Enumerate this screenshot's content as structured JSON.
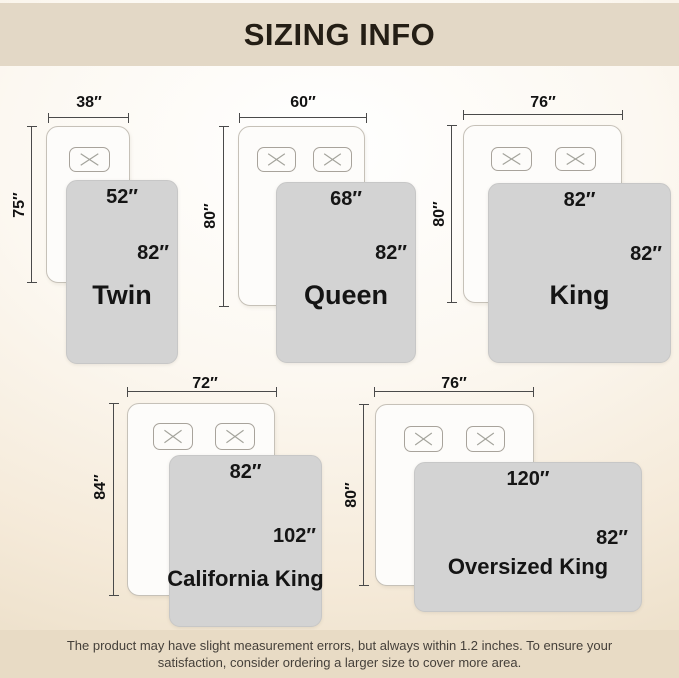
{
  "title": "SIZING INFO",
  "sizes": [
    {
      "name": "Twin",
      "bed_width": "38″",
      "bed_length": "75″",
      "blanket_width": "52″",
      "blanket_length": "82″",
      "pillow_count": 1
    },
    {
      "name": "Queen",
      "bed_width": "60″",
      "bed_length": "80″",
      "blanket_width": "68″",
      "blanket_length": "82″",
      "pillow_count": 2
    },
    {
      "name": "King",
      "bed_width": "76″",
      "bed_length": "80″",
      "blanket_width": "82″",
      "blanket_length": "82″",
      "pillow_count": 2
    },
    {
      "name": "California King",
      "bed_width": "72″",
      "bed_length": "84″",
      "blanket_width": "82″",
      "blanket_length": "102″",
      "pillow_count": 2
    },
    {
      "name": "Oversized King",
      "bed_width": "76″",
      "bed_length": "80″",
      "blanket_width": "120″",
      "blanket_length": "82″",
      "pillow_count": 2
    }
  ],
  "footer": {
    "line1": "The product may have slight measurement errors, but always within 1.2 inches. To ensure your",
    "line2": "satisfaction, consider ordering a larger size to cover more area."
  },
  "colors": {
    "banner_background": "#e3d8c6",
    "blanket_gray": "#d3d3d3",
    "bed_white": "#fdfcfa",
    "measure_line": "#4a4a4a",
    "text_dark": "#141414",
    "footer_text": "#45403a"
  }
}
